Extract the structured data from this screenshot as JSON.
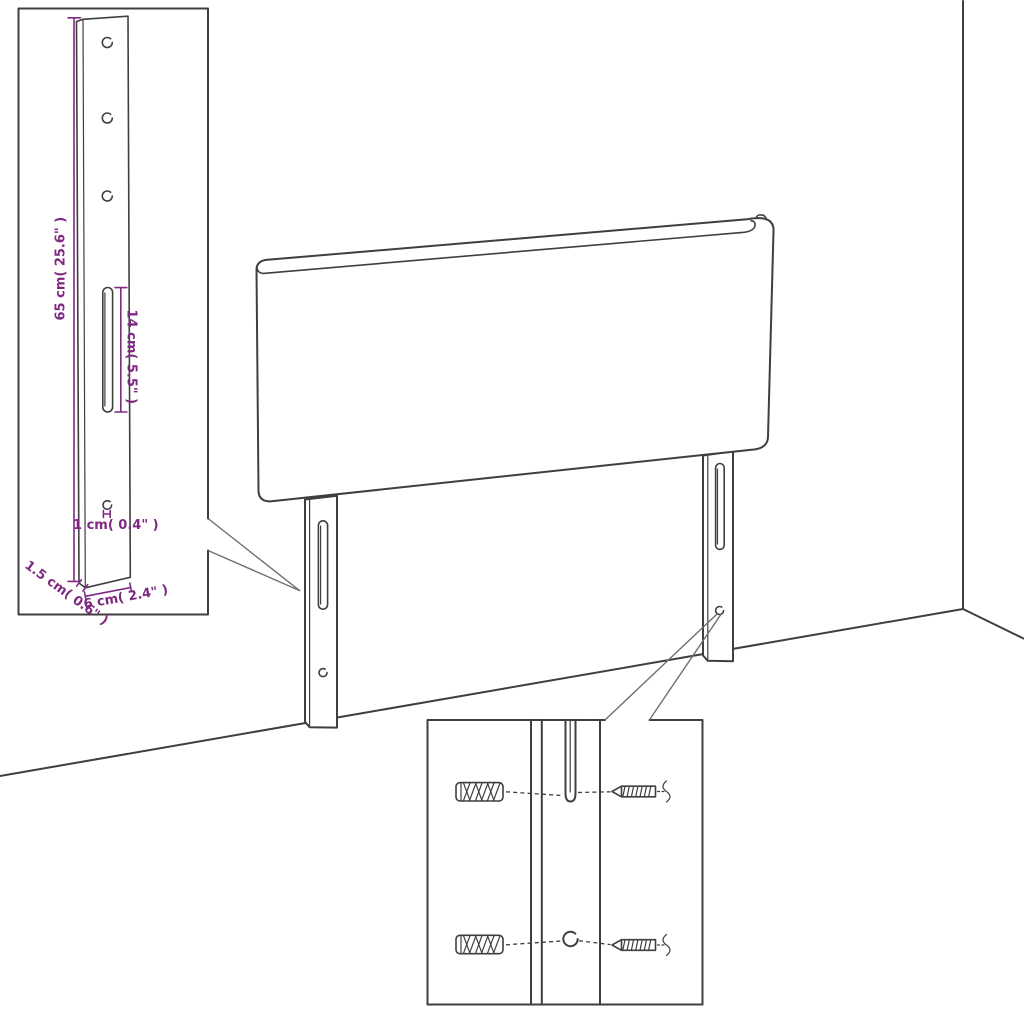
{
  "diagram": {
    "type": "furniture-assembly-dimension-diagram",
    "subject": "headboard-with-two-mounting-struts",
    "colors": {
      "background": "#ffffff",
      "line": "#3f3f3f",
      "dimension": "#7e2a80",
      "leader": "#6f6f6f"
    },
    "detail_inset": {
      "labels": {
        "strut_height": "65 cm( 25.6\" )",
        "slot_length": "14 cm( 5.5\" )",
        "hole_diameter": "1 cm( 0.4\" )",
        "strut_thickness": "1.5 cm( 0.6\" )",
        "strut_width": "6 cm( 2.4\" )"
      }
    },
    "hardware_inset": {
      "wall_plug_count": 2,
      "screw_count": 2
    }
  }
}
